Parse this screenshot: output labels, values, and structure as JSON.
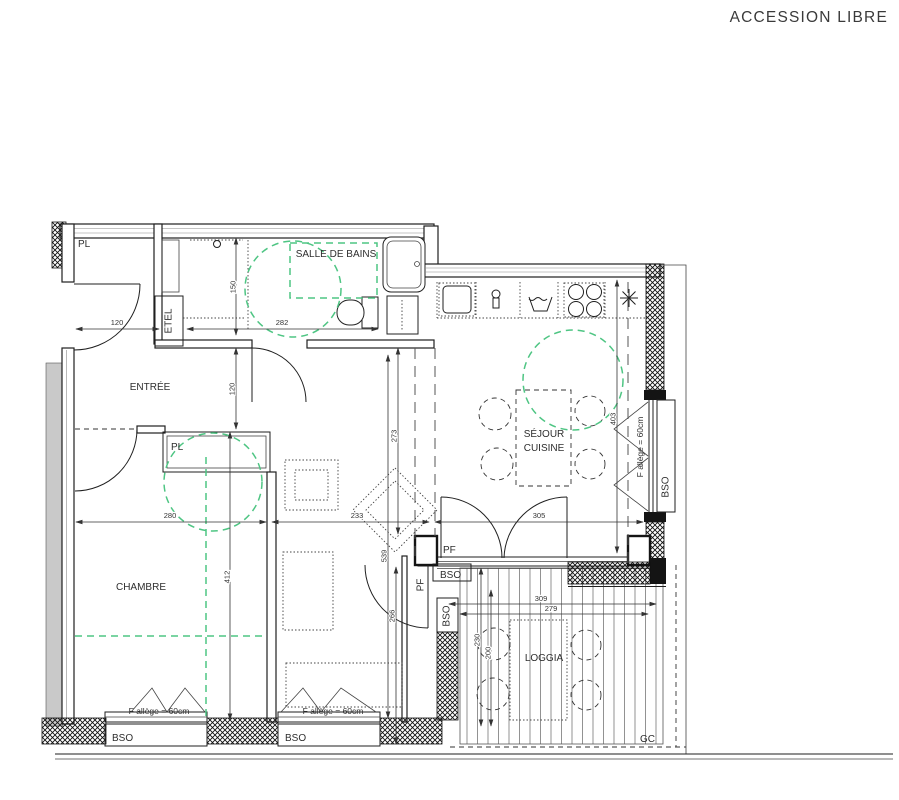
{
  "title": "ACCESSION LIBRE",
  "colors": {
    "green": "#4ec583",
    "grey": "#c9c9c9",
    "text": "#2e2e2e"
  },
  "rooms": {
    "closet_top": "PL",
    "bathroom": "SALLE DE BAINS",
    "duct": "ETEL",
    "entry": "ENTRÉE",
    "closet_bedroom": "PL",
    "bedroom": "CHAMBRE",
    "living_line1": "SÉJOUR",
    "living_line2": "CUISINE",
    "loggia": "LOGGIA"
  },
  "annotations": {
    "pf_living": "PF",
    "pf_hall": "PF",
    "bso_hall_top": "BSO",
    "bso_hall_side": "BSO",
    "bso_east": "BSO",
    "bso_window_left": "BSO",
    "bso_window_mid": "BSO",
    "gc": "GC",
    "allege_left": "F allège = 60cm",
    "allege_mid": "F allège = 60cm",
    "allege_east": "F allège = 60cm"
  },
  "dimensions": {
    "door_entry": "120",
    "bathroom_width": "282",
    "bathroom_depth": "150",
    "entry_depth": "120",
    "bedroom_width": "280",
    "hall_width": "233",
    "living_width": "305",
    "living_depth": "273",
    "bedroom_depth": "412",
    "hall_depth": "539",
    "east_window": "403",
    "pf_to_edge": "266",
    "loggia_width_outer": "309",
    "loggia_width_inner": "279",
    "loggia_depth_outer": "230",
    "loggia_depth_inner": "200"
  }
}
